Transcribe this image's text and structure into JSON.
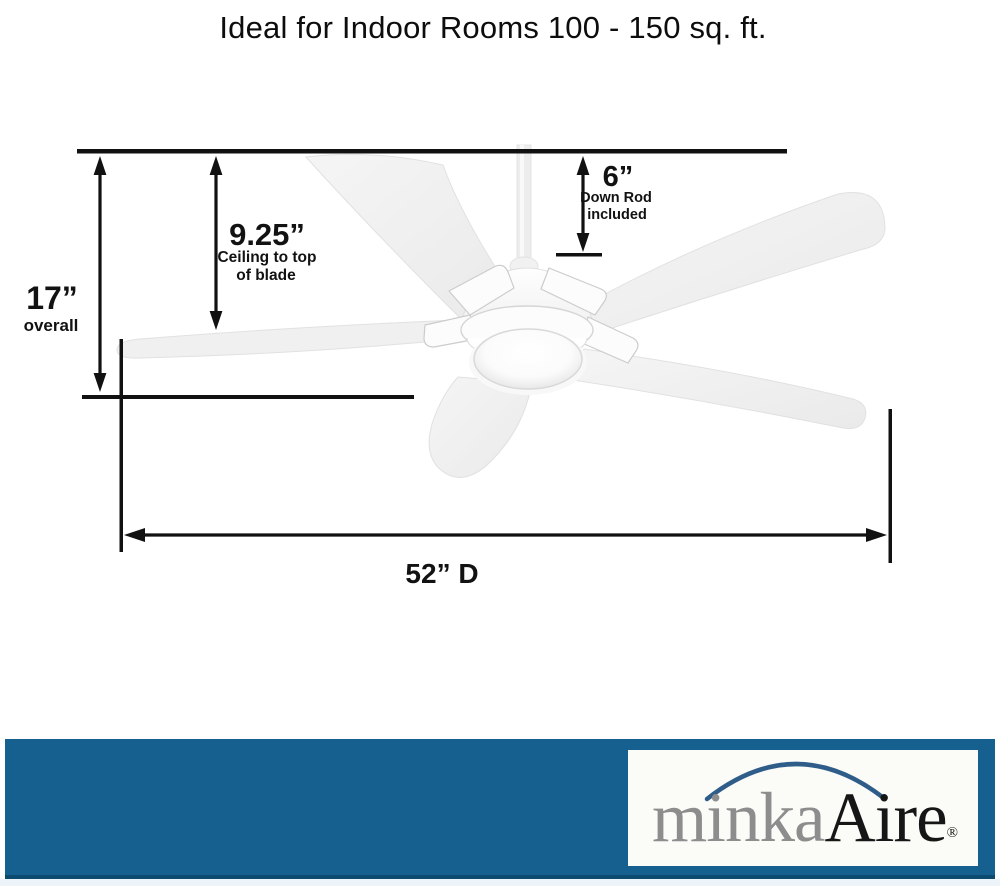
{
  "title": "Ideal for Indoor Rooms 100 - 150 sq. ft.",
  "dimensions": {
    "overall": {
      "value": "17”",
      "label": "overall"
    },
    "ceiling_to_blade": {
      "value": "9.25”",
      "line1": "Ceiling to top",
      "line2": "of blade"
    },
    "down_rod": {
      "value": "6”",
      "line1": "Down Rod",
      "line2": "included"
    },
    "diameter": {
      "value": "52” D"
    }
  },
  "footer": {
    "brand_gray": "minka",
    "brand_dark": "Aire",
    "registered": "®"
  },
  "colors": {
    "dimension_line": "#111111",
    "band_blue": "#15608f",
    "band_bottom_edge": "#0d4a70",
    "bottom_strip": "#ecf4fa",
    "logo_arc_blue": "#2e5d8a",
    "brand_gray_text": "#8d8d8d",
    "brand_dark_text": "#161616",
    "fan_body": "#f1f1f1"
  }
}
